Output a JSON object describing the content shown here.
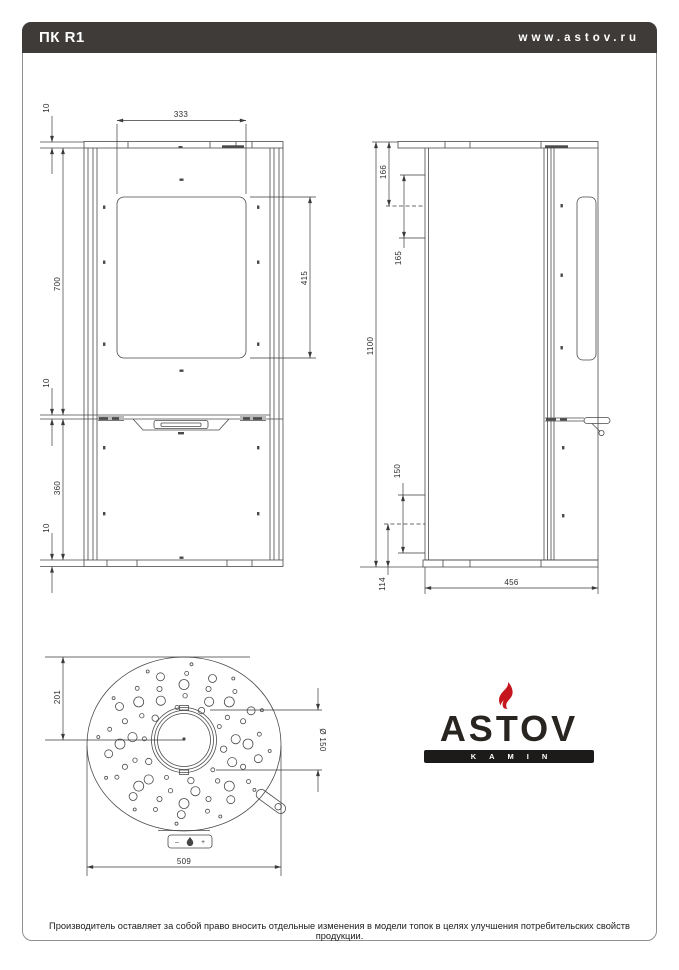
{
  "header": {
    "model": "ПК R1",
    "website": "www.astov.ru"
  },
  "logo": {
    "brand": "ASTOV",
    "sub": "KAMIN"
  },
  "footer": {
    "disclaimer": "Производитель оставляет за собой право вносить отдельные изменения в модели топок в целях улучшения потребительских свойств продукции."
  },
  "dims": {
    "front": {
      "glass_width": "333",
      "plate": "10",
      "upper": "700",
      "glass_height": "415",
      "mid": "10",
      "pedestal": "360",
      "base": "10"
    },
    "side": {
      "total": "1100",
      "t1": "166",
      "t2": "165",
      "b1": "150",
      "b2": "114",
      "depth": "456"
    },
    "top": {
      "back": "201",
      "width": "509",
      "flue": "Ø 150"
    }
  },
  "controls": {
    "minus": "–",
    "plus": "+"
  },
  "top_view": {
    "center": {
      "x": 184,
      "y": 744
    },
    "hole_rings": [
      {
        "r": 40,
        "n": 10,
        "hole": 3.2,
        "alt": 2.0,
        "off": 8
      },
      {
        "r": 52,
        "n": 13,
        "hole": 4.6,
        "alt": 2.2,
        "off": 22
      },
      {
        "r": 64,
        "n": 16,
        "hole": 5.0,
        "alt": 2.6,
        "off": 0
      },
      {
        "r": 76,
        "n": 18,
        "hole": 4.0,
        "alt": 2.0,
        "off": 12
      },
      {
        "r": 86,
        "n": 12,
        "hole": 1.5,
        "alt": 1.5,
        "off": 5
      }
    ]
  },
  "colors": {
    "line": "#4a4a4a",
    "accent_red": "#c4161c",
    "header_bg": "#3e3b39"
  }
}
